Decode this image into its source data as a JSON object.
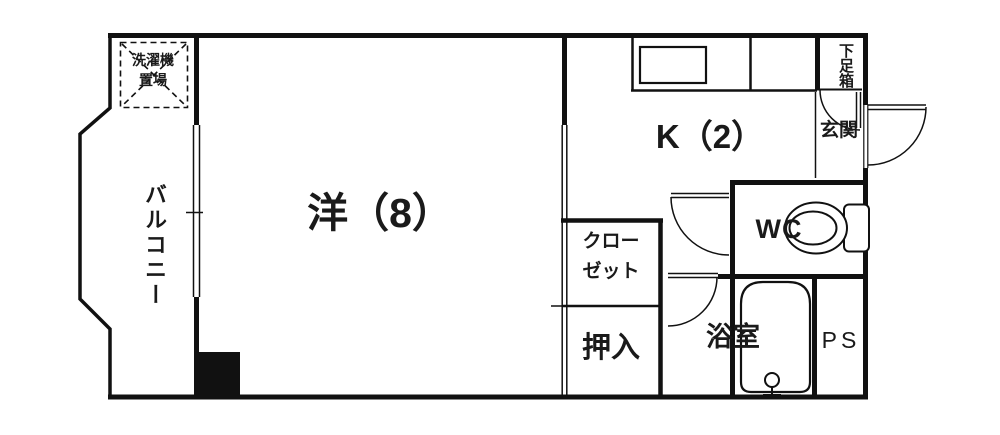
{
  "plan": {
    "title": "1K apartment floor plan",
    "rooms": {
      "western_room": {
        "label": "洋（8）"
      },
      "kitchen": {
        "label": "K（2）"
      },
      "balcony": {
        "label": "バルコニー"
      },
      "washer_area": {
        "label": "洗濯機\n置場"
      },
      "closet": {
        "label": "クロー\nゼット"
      },
      "oshiire": {
        "label": "押入"
      },
      "bathroom": {
        "label": "浴室"
      },
      "toilet": {
        "label": "WC"
      },
      "pipe_space": {
        "label": "PS"
      },
      "entrance": {
        "label": "玄関"
      },
      "shoe_box": {
        "label": "下足箱"
      }
    },
    "colors": {
      "line": "#111111",
      "background": "#ffffff",
      "pillar_fill": "#111111"
    }
  }
}
